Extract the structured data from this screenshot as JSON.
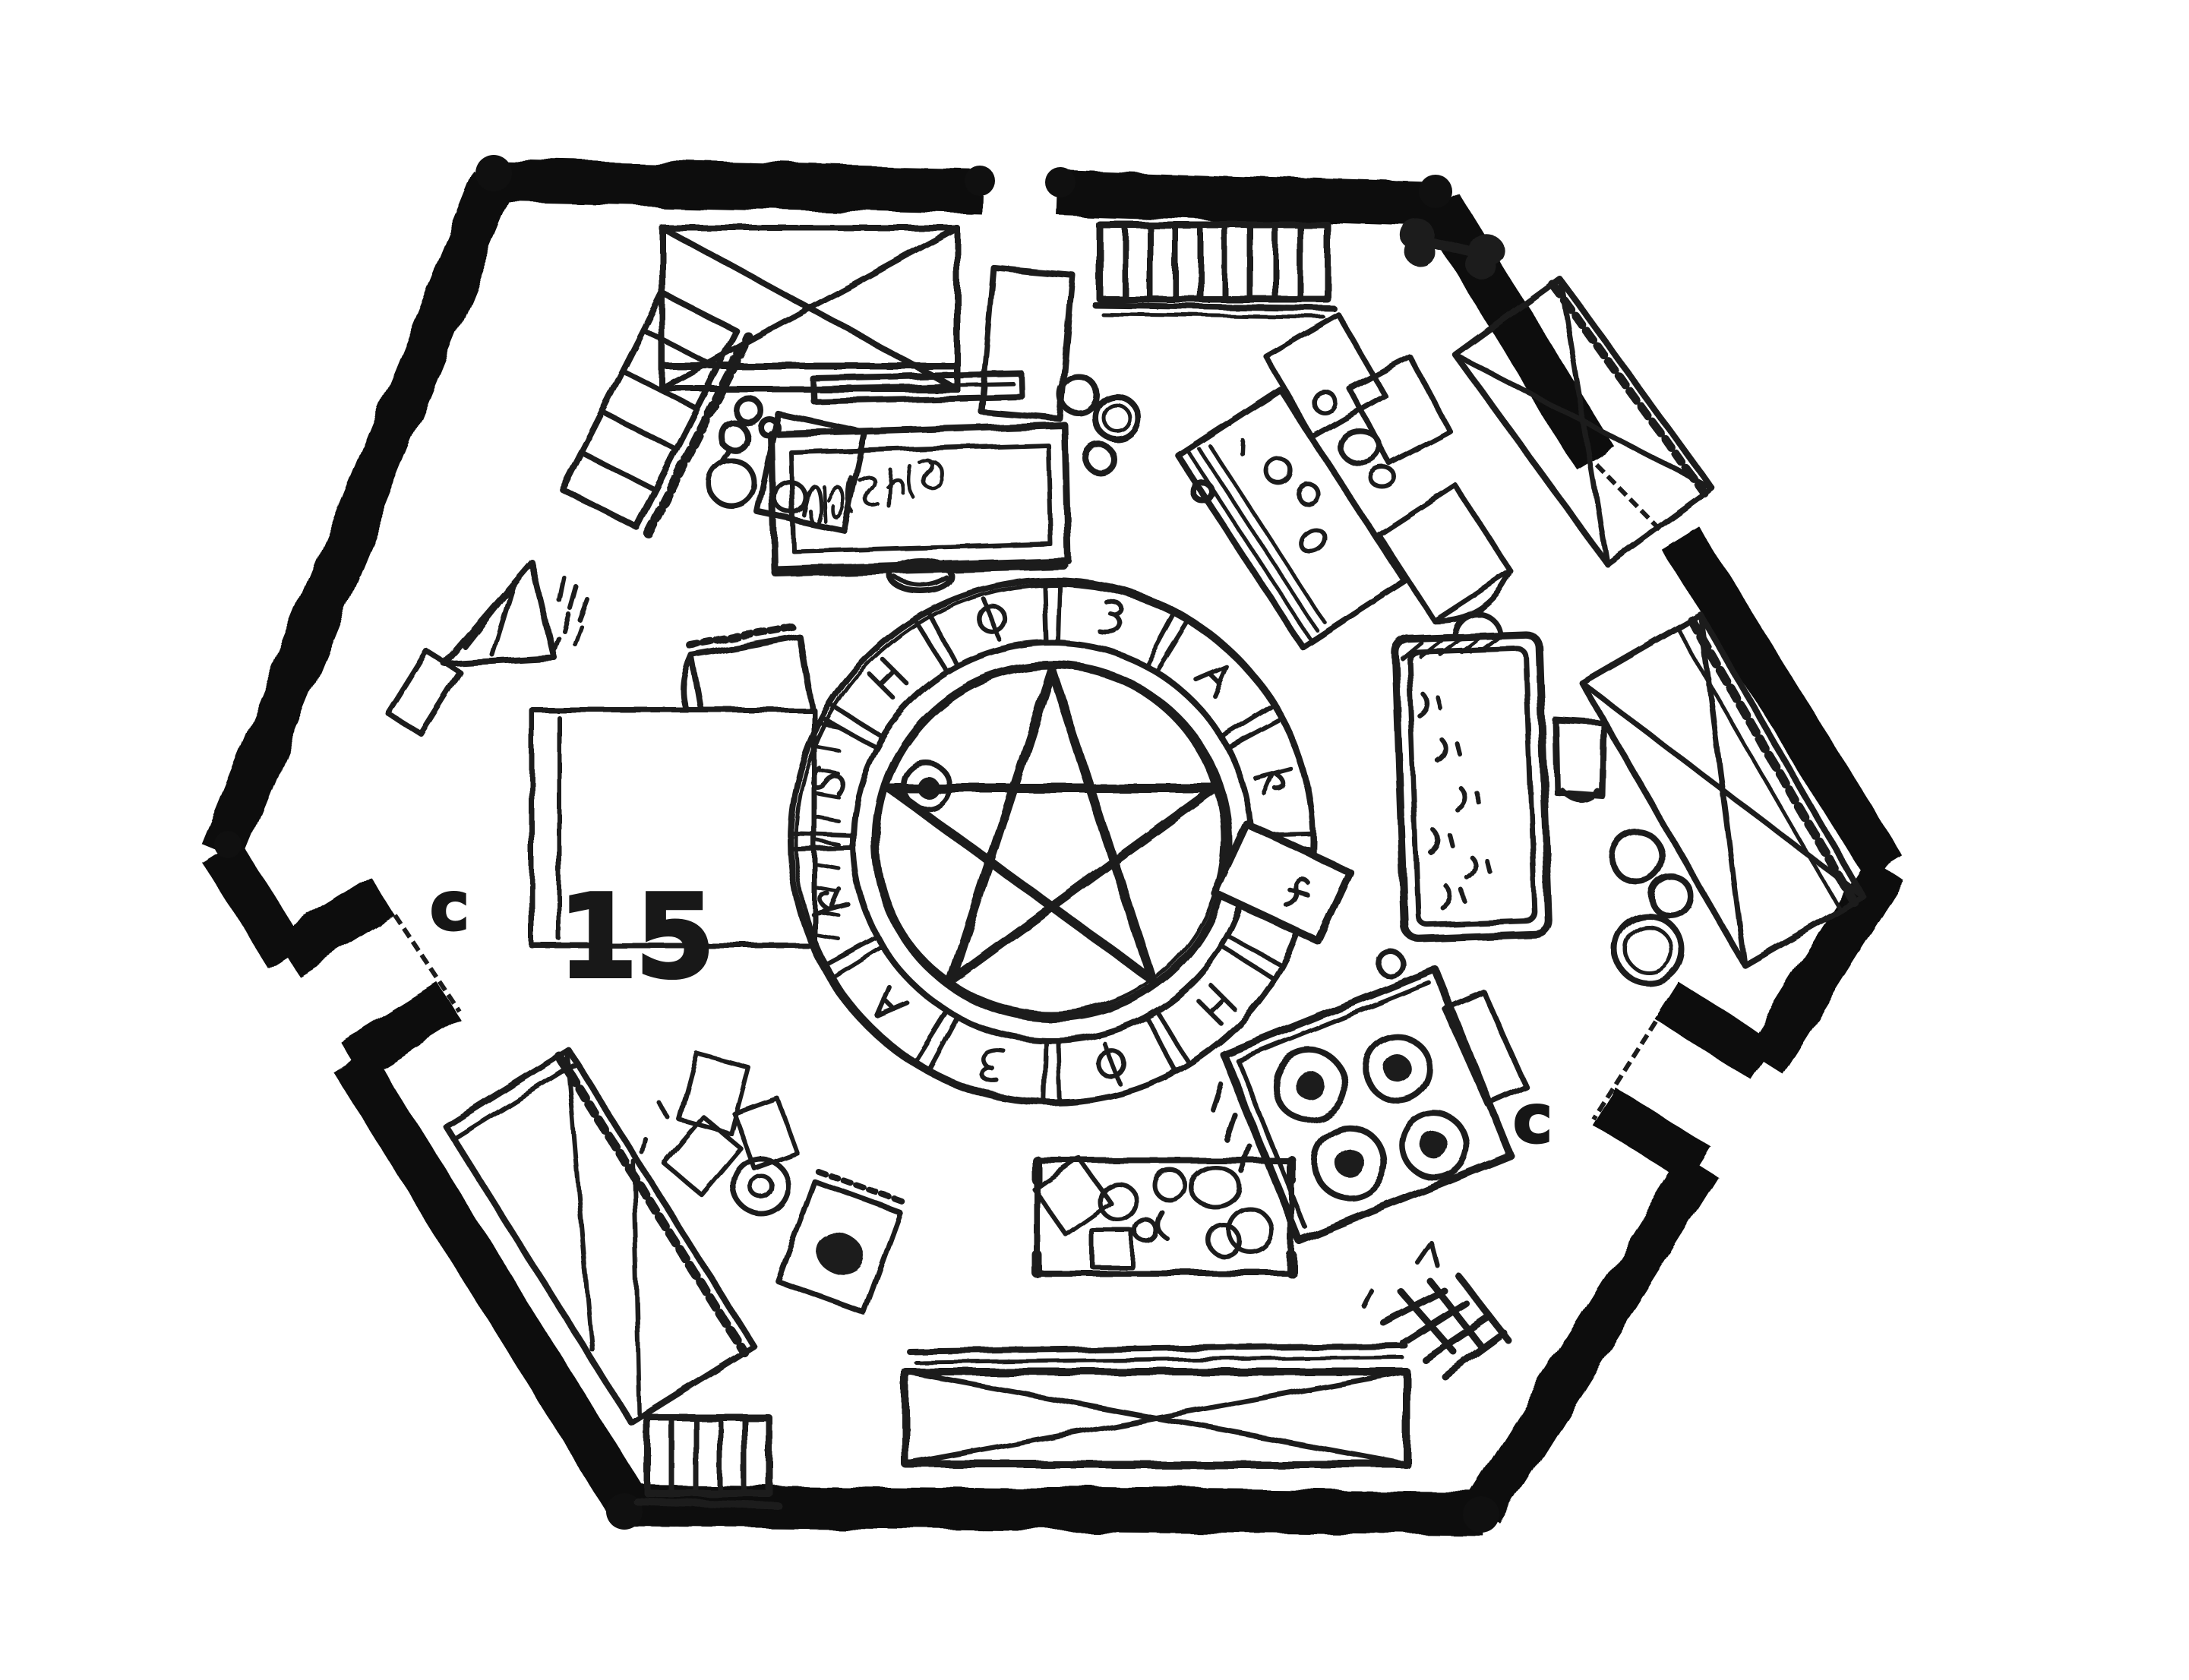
{
  "palette": {
    "paper": "#ffffff",
    "ink": "#1c1c1c",
    "wall": "#101010"
  },
  "map": {
    "title": "hand-drawn hexagonal dungeon room floor plan",
    "room_number": "15",
    "doors": [
      {
        "id": "southwest-door",
        "label": "c"
      },
      {
        "id": "southeast-door",
        "label": "c"
      },
      {
        "id": "north-door",
        "label": ""
      },
      {
        "id": "northeast-door",
        "label": ""
      }
    ],
    "features": [
      "hexagonal-stone-wall",
      "ritual-circle-with-pentagram",
      "rune-ring-12-sectors",
      "center-gem",
      "altar-book-stand",
      "sign-with-illegible-script",
      "beds",
      "square-rug",
      "bathing-pool",
      "stove-4-burners",
      "work-table-with-clutter",
      "storage-crate",
      "barred-shelf",
      "bone",
      "firewood-pile",
      "barrels",
      "chairs",
      "easel",
      "ladder-rack",
      "scattered-papers"
    ]
  }
}
